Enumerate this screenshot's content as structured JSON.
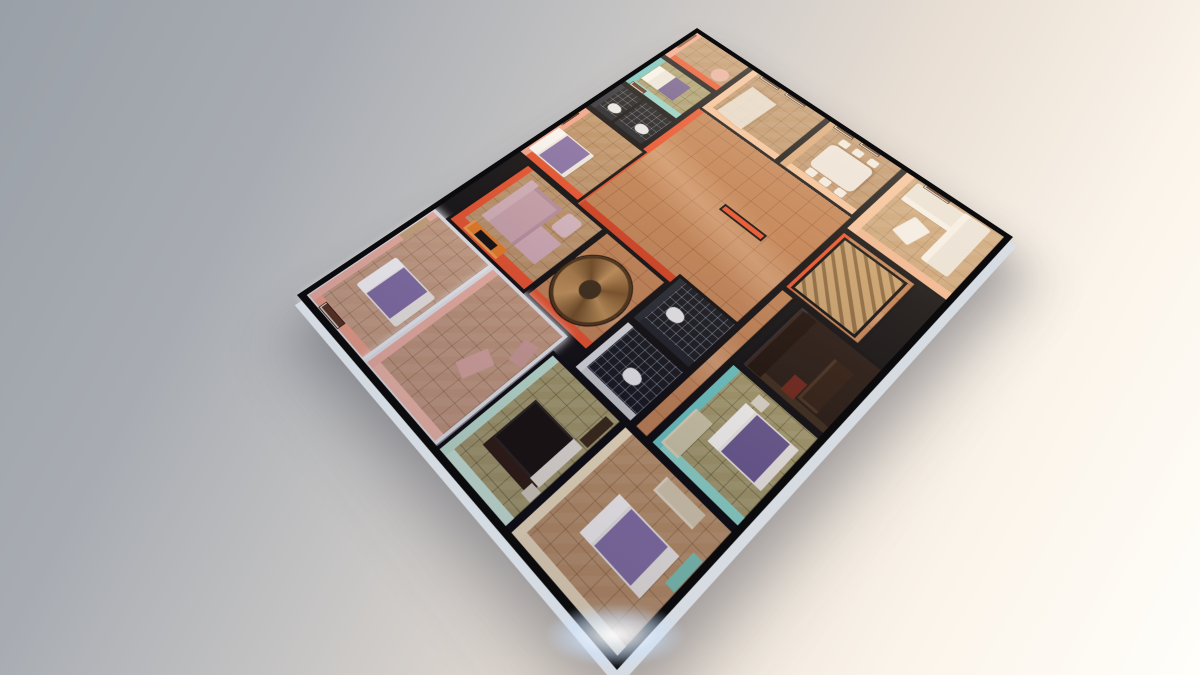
{
  "scene": {
    "description": "3D perspective render of a single-storey apartment floor plan, viewed from above at an angle, floating on a neutral studio background",
    "background_css": "linear-gradient(118deg, #9aa0a8 0%, #a8acb2 22%, #c4c3c3 40%, #e9dfd4 62%, #fbf4ea 80%, #fffefa 100%)",
    "corner_light": {
      "x": 520,
      "y": 592,
      "w": 190,
      "h": 86,
      "css": "background:radial-gradient(closest-side, rgba(255,255,255,.95), rgba(205,228,255,.55) 45%, rgba(205,228,255,0) 75%);filter:blur(2px);"
    },
    "plan": {
      "width": 760,
      "height": 620,
      "matrix3d": [
        0.80808,
        -0.34,
        0,
        0.00040426,
        0.28219,
        0.35081,
        0,
        -0.00037915,
        0,
        0,
        1,
        0,
        297,
        295,
        0,
        1
      ]
    }
  },
  "palette": {
    "black": "#0c0c0e",
    "wall-orange": "#e8512b",
    "wall-orange-deep": "#d23f1f",
    "wall-salmon": "#f2a58c",
    "wall-pink": "#f0b4a4",
    "wall-peach": "#f4c49c",
    "wall-tan": "#d9a878",
    "wall-teal": "#6cc7c4",
    "wall-mint": "#bfe3d2",
    "wall-cream": "#f1e3c2",
    "wall-white": "#e8eaee",
    "floor-tan": "#bb9268",
    "floor-olive": "#a49a6a",
    "floor-bath": "#14171c",
    "floor-hall": "#c08254",
    "floor-cream": "#c9a377",
    "bed-purple": "#8672a8",
    "bed-purple-deep": "#6a5a90",
    "wood": "#a87b46",
    "white-sofa": "#eae5dc",
    "pink-sofa": "#c9a3ad"
  },
  "rooms": [
    {
      "name": "hall-central",
      "rect": [
        358,
        130,
        272,
        312
      ],
      "floorClass": "floor-hall",
      "css": "box-shadow:inset 0 12px 0 var(--wall-orange), inset 12px 0 0 var(--wall-orange-deep);"
    },
    {
      "name": "stair-hall-west",
      "rect": [
        212,
        208,
        150,
        124
      ],
      "floorClass": "floor-hall",
      "css": "box-shadow:inset 12px 0 0 var(--wall-orange);"
    },
    {
      "name": "corridor-south",
      "rect": [
        186,
        442,
        280,
        28
      ],
      "floorClass": "floor-hall",
      "css": ""
    },
    {
      "name": "suite-bedroom-white",
      "rect": [
        6,
        6,
        206,
        138
      ],
      "floorClass": "floor-tan",
      "css": "border:5px solid var(--wall-white); box-shadow:0 0 12px 2px rgba(255,255,255,.9), inset 0 12px 0 var(--wall-pink), inset 12px 0 0 var(--wall-salmon); background-color:#c9a083;"
    },
    {
      "name": "suite-room-white",
      "rect": [
        6,
        144,
        206,
        154
      ],
      "floorClass": "floor-tan",
      "css": "border:5px solid var(--wall-white); box-shadow:0 0 12px 2px rgba(255,255,255,.9), inset 0 12px 0 var(--wall-pink), inset 12px 0 0 #f4bdab; background-color:#c49a7e;"
    },
    {
      "name": "tv-lounge",
      "rect": [
        212,
        34,
        150,
        174
      ],
      "floorClass": "floor-tan",
      "css": "box-shadow:inset 0 12px 0 var(--wall-orange), inset 16px 0 0 var(--wall-orange);"
    },
    {
      "name": "bedroom-north",
      "rect": [
        362,
        4,
        140,
        140
      ],
      "floorClass": "floor-tan",
      "css": "box-shadow:inset 0 12px 0 var(--wall-salmon), inset 12px 0 0 var(--wall-orange);"
    },
    {
      "name": "bathroom-north",
      "rect": [
        502,
        4,
        76,
        126
      ],
      "floorClass": "floor-dark",
      "css": "box-shadow:inset 0 10px 0 #252a33, inset 10px 0 0 #1a1e26;"
    },
    {
      "name": "bedroom-teal-north",
      "rect": [
        578,
        4,
        90,
        126
      ],
      "floorClass": "floor-olive",
      "css": "box-shadow:inset 0 12px 0 var(--wall-teal), inset 12px 0 0 #8fd4cd;"
    },
    {
      "name": "foyer-northeast",
      "rect": [
        668,
        4,
        88,
        128
      ],
      "floorClass": "floor-tan",
      "css": "box-shadow:inset 0 12px 0 var(--wall-salmon), inset 12px 0 0 var(--wall-orange);"
    },
    {
      "name": "kitchen-east",
      "rect": [
        624,
        132,
        132,
        162
      ],
      "floorClass": "floor-tan",
      "css": "box-shadow:inset 0 12px 0 var(--wall-peach), inset 12px 0 0 var(--wall-peach);"
    },
    {
      "name": "dining-east",
      "rect": [
        624,
        294,
        132,
        146
      ],
      "floorClass": "floor-tan",
      "css": "box-shadow:inset 0 12px 0 var(--wall-tan), inset 12px 0 0 var(--wall-peach);"
    },
    {
      "name": "living-southeast",
      "rect": [
        600,
        440,
        156,
        176
      ],
      "floorClass": "floor-cream",
      "css": "box-shadow:inset 0 14px 0 var(--wall-peach), inset 14px 0 0 #f0b892;"
    },
    {
      "name": "bathroom-center-west",
      "rect": [
        186,
        332,
        100,
        110
      ],
      "floorClass": "floor-dark",
      "css": "box-shadow:inset 0 10px 0 #d9dbe0, inset 10px 0 0 #c8cace;"
    },
    {
      "name": "bathroom-center-east",
      "rect": [
        286,
        332,
        96,
        110
      ],
      "floorClass": "floor-dark",
      "css": "box-shadow:inset 0 10px 0 #232830, inset 10px 0 0 #1a1e26;"
    },
    {
      "name": "bedroom-mint-west",
      "rect": [
        4,
        300,
        182,
        134
      ],
      "floorClass": "floor-olive",
      "css": "box-shadow:inset 0 12px 0 var(--wall-mint), inset 12px 0 0 #cdebdc;"
    },
    {
      "name": "bedroom-southwest",
      "rect": [
        4,
        434,
        182,
        182
      ],
      "floorClass": "floor-tan",
      "css": "box-shadow:inset 0 12px 0 var(--wall-cream), inset 12px 0 0 #efe0bf;"
    },
    {
      "name": "bedroom-teal-south",
      "rect": [
        186,
        470,
        152,
        146
      ],
      "floorClass": "floor-olive",
      "css": "box-shadow:inset 0 12px 0 var(--wall-teal), inset 12px 0 0 #8fd8cc;"
    },
    {
      "name": "study-dark",
      "rect": [
        338,
        478,
        126,
        138
      ],
      "floorClass": "",
      "css": "background:#241811; box-shadow:inset 0 10px 0 #2a2f3a, inset 10px 0 0 #3a2a1a;"
    },
    {
      "name": "stair-room-east",
      "rect": [
        464,
        442,
        136,
        130
      ],
      "floorClass": "floor-hall",
      "css": "box-shadow:inset 0 12px 0 var(--wall-orange);"
    }
  ],
  "furniture": [
    {
      "name": "suite-bed-mattress",
      "rect": [
        64,
        40,
        62,
        92
      ],
      "css": "background:#f2efe8;border-radius:4px;box-shadow:inset 0 20px 0 #ffffff;"
    },
    {
      "name": "suite-bed-blanket",
      "rect": [
        66,
        62,
        58,
        54
      ],
      "css": "background:var(--bed-purple);"
    },
    {
      "name": "suite-wall-frame",
      "rect": [
        10,
        36,
        12,
        46
      ],
      "cls": "frame",
      "css": ""
    },
    {
      "name": "suite-shelf",
      "rect": [
        150,
        12,
        44,
        12
      ],
      "css": "background:#caa87c;"
    },
    {
      "name": "suite-room-cushion-1",
      "rect": [
        84,
        232,
        42,
        26
      ],
      "css": "background:#dba9a0;transform:rotate(18deg);"
    },
    {
      "name": "suite-room-cushion-2",
      "rect": [
        140,
        266,
        34,
        22
      ],
      "css": "background:#cf9f98;transform:rotate(-12deg);"
    },
    {
      "name": "tv-cabinet",
      "rect": [
        220,
        64,
        20,
        74
      ],
      "css": "background:#e87a22;box-shadow:inset 4px 4px 0 #f29a4a;"
    },
    {
      "name": "tv-screen",
      "rect": [
        224,
        84,
        12,
        38
      ],
      "css": "background:var(--black);"
    },
    {
      "name": "sectional-sofa-back",
      "rect": [
        252,
        64,
        92,
        16
      ],
      "css": "background:#d4b2bb;"
    },
    {
      "name": "sectional-sofa-seat",
      "rect": [
        252,
        80,
        88,
        58
      ],
      "css": "background:var(--pink-sofa);box-shadow:inset -6px -6px 0 #b890a0;"
    },
    {
      "name": "sectional-chaise",
      "rect": [
        252,
        138,
        48,
        44
      ],
      "css": "background:#cfaab6;"
    },
    {
      "name": "lounge-pouf",
      "rect": [
        308,
        148,
        36,
        30
      ],
      "css": "background:#d8bac4;border-radius:6px;"
    },
    {
      "name": "bedroom-north-bed",
      "rect": [
        380,
        12,
        60,
        82
      ],
      "css": "background:#f0ede6;border-radius:3px;box-shadow:inset 0 18px 0 #fbfaf7;"
    },
    {
      "name": "bedroom-north-blanket",
      "rect": [
        382,
        34,
        56,
        52
      ],
      "css": "background:var(--bed-purple);"
    },
    {
      "name": "bedroom-north-frame",
      "rect": [
        446,
        2,
        36,
        10
      ],
      "cls": "frame",
      "css": ""
    },
    {
      "name": "bath-north-divider",
      "rect": [
        504,
        58,
        72,
        6
      ],
      "css": "background:var(--black);"
    },
    {
      "name": "bath-north-toilet-1",
      "rect": [
        520,
        30,
        18,
        24
      ],
      "css": "background:#e8eaec;border-radius:40% 40% 50% 50%;"
    },
    {
      "name": "bath-north-toilet-2",
      "rect": [
        520,
        92,
        18,
        24
      ],
      "css": "background:#e8eaec;border-radius:40% 40% 50% 50%;"
    },
    {
      "name": "teal-north-bed",
      "rect": [
        606,
        22,
        42,
        72
      ],
      "css": "background:#eceae2;box-shadow:inset 0 14px 0 #f8f8f4, inset 0 -34px 0 var(--bed-purple-deep);"
    },
    {
      "name": "teal-north-frame",
      "rect": [
        582,
        18,
        10,
        32
      ],
      "cls": "frame",
      "css": ""
    },
    {
      "name": "foyer-door-frame",
      "rect": [
        700,
        2,
        46,
        12
      ],
      "css": "background:#7a4a28;box-shadow:inset 4px 3px 0 #a87850;"
    },
    {
      "name": "foyer-round-table",
      "rect": [
        688,
        92,
        30,
        30
      ],
      "css": "background:#e8b0a0;border-radius:50%;"
    },
    {
      "name": "kitchen-counter",
      "rect": [
        640,
        160,
        80,
        54
      ],
      "css": "background:rgba(240,238,230,.8);box-shadow:2px 2px 6px rgba(120,80,40,.4);transform:rotate(3deg);"
    },
    {
      "name": "kitchen-frame-1",
      "rect": [
        744,
        156,
        10,
        40
      ],
      "cls": "frame",
      "css": ""
    },
    {
      "name": "kitchen-frame-2",
      "rect": [
        744,
        210,
        10,
        40
      ],
      "cls": "frame",
      "css": ""
    },
    {
      "name": "dining-table",
      "rect": [
        658,
        330,
        60,
        80
      ],
      "css": "background:#ece8e0;border-radius:10px;box-shadow:2px 2px 4px rgba(100,60,30,.5);"
    },
    {
      "name": "dining-chair-1",
      "rect": [
        642,
        336,
        14,
        16
      ],
      "css": "background:#f2efe8;border-radius:3px;"
    },
    {
      "name": "dining-chair-2",
      "rect": [
        642,
        362,
        14,
        16
      ],
      "css": "background:#f2efe8;border-radius:3px;"
    },
    {
      "name": "dining-chair-3",
      "rect": [
        642,
        390,
        14,
        16
      ],
      "css": "background:#f2efe8;border-radius:3px;"
    },
    {
      "name": "dining-chair-4",
      "rect": [
        722,
        336,
        14,
        16
      ],
      "css": "background:#f2efe8;border-radius:3px;"
    },
    {
      "name": "dining-chair-5",
      "rect": [
        722,
        362,
        14,
        16
      ],
      "css": "background:#f2efe8;border-radius:3px;"
    },
    {
      "name": "dining-chair-6",
      "rect": [
        722,
        390,
        14,
        16
      ],
      "css": "background:#f2efe8;border-radius:3px;"
    },
    {
      "name": "dining-frame-1",
      "rect": [
        744,
        310,
        10,
        36
      ],
      "cls": "frame",
      "css": ""
    },
    {
      "name": "dining-frame-2",
      "rect": [
        744,
        360,
        10,
        36
      ],
      "cls": "frame",
      "css": ""
    },
    {
      "name": "living-sofa-east",
      "rect": [
        702,
        468,
        44,
        124
      ],
      "css": "background:var(--white-sofa);box-shadow:inset 10px 0 0 #f6f3ec;border-radius:4px;"
    },
    {
      "name": "living-sofa-south",
      "rect": [
        636,
        548,
        112,
        44
      ],
      "css": "background:var(--white-sofa);box-shadow:inset 0 10px 0 #f6f3ec;border-radius:4px;"
    },
    {
      "name": "living-floor-cushion",
      "rect": [
        644,
        496,
        44,
        32
      ],
      "css": "background:#f4f1ea;transform:rotate(14deg);border-radius:3px;"
    },
    {
      "name": "living-frame",
      "rect": [
        744,
        478,
        10,
        44
      ],
      "cls": "frame",
      "css": ""
    },
    {
      "name": "mint-bed-headboard",
      "rect": [
        48,
        336,
        14,
        84
      ],
      "css": "background:#2e1c10;"
    },
    {
      "name": "mint-bed-dark",
      "rect": [
        62,
        336,
        66,
        86
      ],
      "css": "background:#17120e;box-shadow:inset 0 -16px 0 #e8e4da, inset 0 0 0 3px #2a241e;"
    },
    {
      "name": "mint-bench",
      "rect": [
        132,
        412,
        42,
        14
      ],
      "css": "background:#3a2a18;"
    },
    {
      "name": "mint-side-table",
      "rect": [
        44,
        412,
        16,
        16
      ],
      "css": "background:#d8d2c2;"
    },
    {
      "name": "sw-bed-mattress",
      "rect": [
        62,
        492,
        60,
        96
      ],
      "css": "background:#f0ede6;box-shadow:inset 0 18px 0 #fbfaf7, inset 0 -14px 0 #f2efe8;"
    },
    {
      "name": "sw-bed-blanket",
      "rect": [
        64,
        514,
        56,
        58
      ],
      "css": "background:var(--bed-purple);"
    },
    {
      "name": "sw-desk",
      "rect": [
        152,
        516,
        22,
        62
      ],
      "css": "background:#d9cdb0;box-shadow:inset 3px 3px 0 #e8dfc8;"
    },
    {
      "name": "sw-rug",
      "rect": [
        92,
        596,
        44,
        14
      ],
      "css": "background:#7fc8b8;"
    },
    {
      "name": "teal-south-cabinet",
      "rect": [
        198,
        482,
        60,
        28
      ],
      "css": "background:#cfc9a8;box-shadow:inset 3px 3px 0 #ddd8bb;"
    },
    {
      "name": "teal-south-bed",
      "rect": [
        238,
        520,
        68,
        84
      ],
      "css": "background:#f0ede6;box-shadow:inset 0 16px 0 #fafaf6;"
    },
    {
      "name": "teal-south-blanket",
      "rect": [
        240,
        540,
        64,
        52
      ],
      "css": "background:var(--bed-purple-deep);"
    },
    {
      "name": "teal-south-nightstand",
      "rect": [
        310,
        524,
        16,
        18
      ],
      "css": "background:#e0dccc;"
    },
    {
      "name": "study-wardrobe",
      "rect": [
        344,
        484,
        112,
        26
      ],
      "css": "background:#1a0f08;box-shadow:inset 0 4px 0 #33201a;"
    },
    {
      "name": "study-desk",
      "rect": [
        356,
        560,
        74,
        30
      ],
      "css": "background:#2e1c10;box-shadow:inset 4px 4px 0 #45301e;"
    },
    {
      "name": "study-red-accent",
      "rect": [
        350,
        538,
        28,
        20
      ],
      "css": "background:#6e2418;"
    },
    {
      "name": "stairs-straight",
      "rect": [
        472,
        452,
        118,
        108
      ],
      "css": "background:repeating-linear-gradient(135deg,#c8a16e 0 10px,#8a6840 10px 15px);border:4px solid var(--black);"
    },
    {
      "name": "bath-center-west-toilet",
      "rect": [
        222,
        384,
        20,
        26
      ],
      "css": "background:#e8eaec;border-radius:40% 40% 50% 50%;"
    },
    {
      "name": "bath-center-east-toilet",
      "rect": [
        322,
        360,
        20,
        26
      ],
      "css": "background:#e8eaec;border-radius:40% 40% 50% 50%;"
    },
    {
      "name": "spiral-staircase",
      "rect": [
        226,
        212,
        108,
        108
      ],
      "css": "border-radius:50%;background:conic-gradient(#a87b46,#6e4a22 12%,#c09058 25%,#7a5226 40%,#b98c52 55%,#6e4a22 70%,#c09058 85%,#a87b46);border:4px solid #4a3014;box-shadow:0 0 0 2px #1c1208;"
    },
    {
      "name": "spiral-staircase-newel",
      "rect": [
        264,
        250,
        30,
        30
      ],
      "css": "background:#3a2a16;border-radius:50%;"
    },
    {
      "name": "hall-wall-stub",
      "rect": [
        500,
        294,
        14,
        80
      ],
      "css": "background:var(--wall-orange);border:3px solid var(--black);"
    }
  ],
  "overlays": [
    {
      "name": "sunlight-overlay",
      "rect": [
        0,
        0,
        760,
        620
      ],
      "css": "background:linear-gradient(258deg, rgba(255,232,205,.30) 5%, rgba(255,210,170,.12) 35%, rgba(30,20,60,.14) 75%, rgba(25,18,55,.20) 100%);"
    },
    {
      "name": "building-outline",
      "rect": [
        0,
        0,
        760,
        620
      ],
      "css": "border:9px solid #0b0b0d;background:transparent;box-shadow:-10px 12px 0 rgba(216,222,230,.95), -34px 44px 70px rgba(55,58,70,.45);"
    }
  ]
}
